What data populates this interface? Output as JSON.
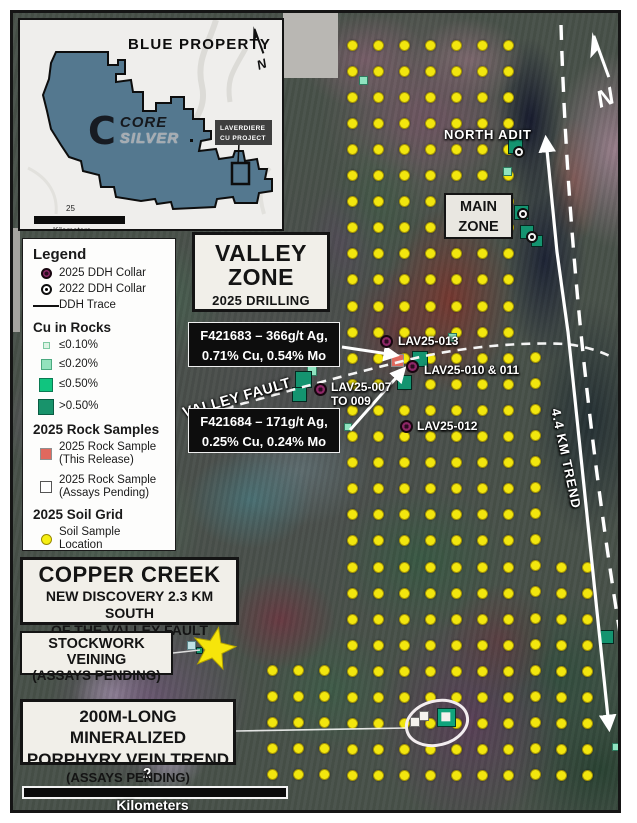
{
  "inset": {
    "title": "BLUE PROPERTY",
    "logo_letter": "C",
    "logo_top": "CORE",
    "logo_bottom": "SILVER",
    "project_line1": "LAVERDIERE",
    "project_line2": "CU PROJECT",
    "scale_value": "25",
    "scale_unit": "Kilometers"
  },
  "legend": {
    "title": "Legend",
    "ddh_2025": "2025 DDH Collar",
    "ddh_2022": "2022 DDH Collar",
    "ddh_trace": "DDH Trace",
    "cu_title": "Cu in Rocks",
    "cu1": "≤0.10%",
    "cu2": "≤0.20%",
    "cu3": "≤0.50%",
    "cu4": ">0.50%",
    "rock_title": "2025 Rock Samples",
    "rock1_l1": "2025 Rock Sample",
    "rock1_l2": "(This Release)",
    "rock2_l1": "2025 Rock Sample",
    "rock2_l2": "(Assays Pending)",
    "soil_title": "2025 Soil Grid",
    "soil_label": "Soil Sample Location"
  },
  "valley_zone": {
    "l1": "VALLEY",
    "l2": "ZONE",
    "l3": "2025 DRILLING"
  },
  "callouts": [
    {
      "line1": "F421683 – 366g/t Ag,",
      "line2": "0.71% Cu, 0.54% Mo"
    },
    {
      "line1": "F421684 – 171g/t Ag,",
      "line2": "0.25% Cu, 0.24% Mo"
    }
  ],
  "labels": {
    "north_adit": "NORTH ADIT",
    "main_l1": "MAIN",
    "main_l2": "ZONE",
    "valley_fault": "VALLEY FAULT",
    "trend": "4.4 KM TREND",
    "lav013": "LAV25-013",
    "lav010": "LAV25-010 & 011",
    "lav007_l1": "LAV25-007",
    "lav007_l2": "TO 009",
    "lav012": "LAV25-012"
  },
  "copper": {
    "title": "COPPER CREEK",
    "sub1": "NEW DISCOVERY 2.3 KM SOUTH",
    "sub2": "OF THE VALLEY FAULT"
  },
  "stockwork": {
    "l1": "STOCKWORK VEINING",
    "l2": "(ASSAYS PENDING)"
  },
  "porphyry": {
    "l1": "200M-LONG MINERALIZED",
    "l2": "PORPHYRY VEIN TREND",
    "l3": "(ASSAYS PENDING)"
  },
  "scalebar": {
    "value": "2",
    "unit": "Kilometers"
  },
  "colors": {
    "soil_dot": "#f2e60e",
    "cu_light": "#ddf3e4",
    "cu_med": "#93e2bd",
    "cu_strong": "#10c57f",
    "cu_dark": "#18936b",
    "collar_2025": "#8d2767",
    "rock_this_release": "#e0695e",
    "property_fill": "#54788f"
  },
  "soil_grid": {
    "dx": 26.1,
    "dy": 26.1,
    "dot": 11,
    "blocks": [
      {
        "x0": 352,
        "y0": 45,
        "cols": 7,
        "rows": 29
      },
      {
        "x0": 535,
        "y0": 357,
        "cols": 1,
        "rows": 17
      },
      {
        "x0": 561,
        "y0": 567,
        "cols": 2,
        "rows": 9
      },
      {
        "x0": 272,
        "y0": 670,
        "cols": 3,
        "rows": 5
      }
    ]
  },
  "markers": {
    "collars_2025": [
      {
        "x": 386,
        "y": 341
      },
      {
        "x": 412,
        "y": 366
      },
      {
        "x": 320,
        "y": 389
      },
      {
        "x": 406,
        "y": 426
      }
    ],
    "collars_2022": [
      {
        "x": 519,
        "y": 152
      },
      {
        "x": 523,
        "y": 214
      },
      {
        "x": 532,
        "y": 237
      }
    ],
    "rock_samples": [
      {
        "x": 363,
        "y": 80,
        "s": 9,
        "t": "med"
      },
      {
        "x": 515,
        "y": 146,
        "s": 15,
        "t": "dark"
      },
      {
        "x": 507,
        "y": 171,
        "s": 9,
        "t": "med"
      },
      {
        "x": 521,
        "y": 212,
        "s": 15,
        "t": "dark"
      },
      {
        "x": 527,
        "y": 232,
        "s": 14,
        "t": "dark"
      },
      {
        "x": 537,
        "y": 241,
        "s": 12,
        "t": "dark"
      },
      {
        "x": 312,
        "y": 371,
        "s": 10,
        "t": "med"
      },
      {
        "x": 303,
        "y": 379,
        "s": 17,
        "t": "dark"
      },
      {
        "x": 299,
        "y": 394,
        "s": 15,
        "t": "dark"
      },
      {
        "x": 420,
        "y": 359,
        "s": 16,
        "t": "dark"
      },
      {
        "x": 404,
        "y": 382,
        "s": 15,
        "t": "dark"
      },
      {
        "x": 452,
        "y": 337,
        "s": 9,
        "t": "med"
      },
      {
        "x": 348,
        "y": 427,
        "s": 8,
        "t": "med"
      },
      {
        "x": 397,
        "y": 360,
        "s": 13,
        "t": "salmon"
      },
      {
        "x": 191,
        "y": 645,
        "s": 9,
        "t": "light"
      },
      {
        "x": 199,
        "y": 650,
        "s": 7,
        "t": "dark"
      },
      {
        "x": 607,
        "y": 637,
        "s": 14,
        "t": "dark"
      },
      {
        "x": 616,
        "y": 747,
        "s": 8,
        "t": "med"
      },
      {
        "x": 446,
        "y": 717,
        "s": 19,
        "t": "core"
      },
      {
        "x": 415,
        "y": 722,
        "s": 10,
        "t": "white"
      },
      {
        "x": 424,
        "y": 716,
        "s": 10,
        "t": "white"
      }
    ]
  }
}
